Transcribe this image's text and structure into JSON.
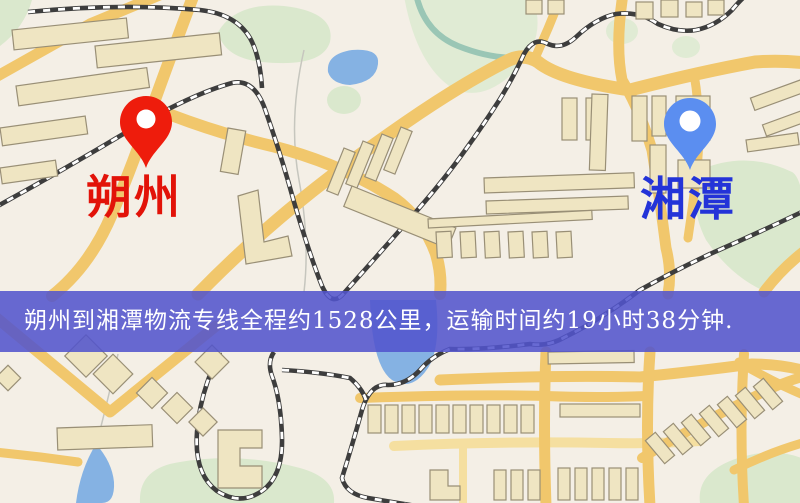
{
  "banner": {
    "text": "朔州到湘潭物流专线全程约1528公里，运输时间约19小时38分钟.",
    "bg_color": "#5254cd",
    "text_color": "#ffffff"
  },
  "origin": {
    "label": "朔州",
    "label_color": "#e21309",
    "pin_color": "#ee1c0c"
  },
  "destination": {
    "label": "湘潭",
    "label_color": "#2333d8",
    "pin_color": "#5b8ef0"
  },
  "map_palette": {
    "background": "#f4efe6",
    "road": "#f1c76c",
    "road_pale": "#f5dfa0",
    "building_fill": "#efe5c2",
    "building_stroke": "#998f76",
    "park": "#dae8cd",
    "park_pale": "#e0ebd4",
    "water": "#85b2e3",
    "river": "#9ac6b5",
    "railway_dark": "#3d3d3d",
    "railway_light": "#ffffff"
  }
}
